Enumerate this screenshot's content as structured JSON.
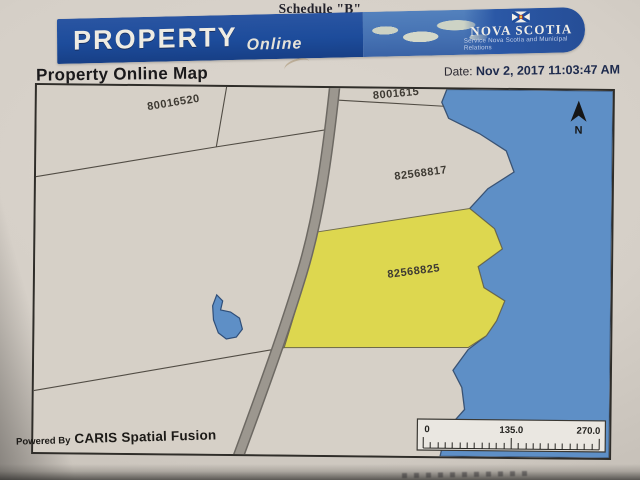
{
  "photo": {
    "schedule_label": "Schedule \"B\""
  },
  "banner": {
    "brand_primary": "PROPERTY",
    "brand_secondary": "Online",
    "org_name": "NOVA SCOTIA",
    "org_tagline": "Service Nova Scotia and Municipal Relations",
    "colors": {
      "banner_blue": "#1d4c9b",
      "panel_blue": "#4571b2"
    }
  },
  "header": {
    "title": "Property Online Map",
    "date_label": "Date:",
    "date_value": "Nov 2, 2017 11:03:47 AM"
  },
  "map": {
    "colors": {
      "land": "#d6d0c7",
      "water": "#5e8fc6",
      "highlight": "#ddd74f",
      "road": "#9c978f"
    },
    "parcels": {
      "topleft": "80016520",
      "topright_clipped": "8001615",
      "middle": "82568817",
      "highlighted": "82568825"
    },
    "north_label": "N",
    "scale_bar": {
      "start": "0",
      "middle": "135.0",
      "end": "270.0"
    },
    "credit": {
      "prefix": "Powered By",
      "name": "CARIS Spatial Fusion"
    }
  }
}
